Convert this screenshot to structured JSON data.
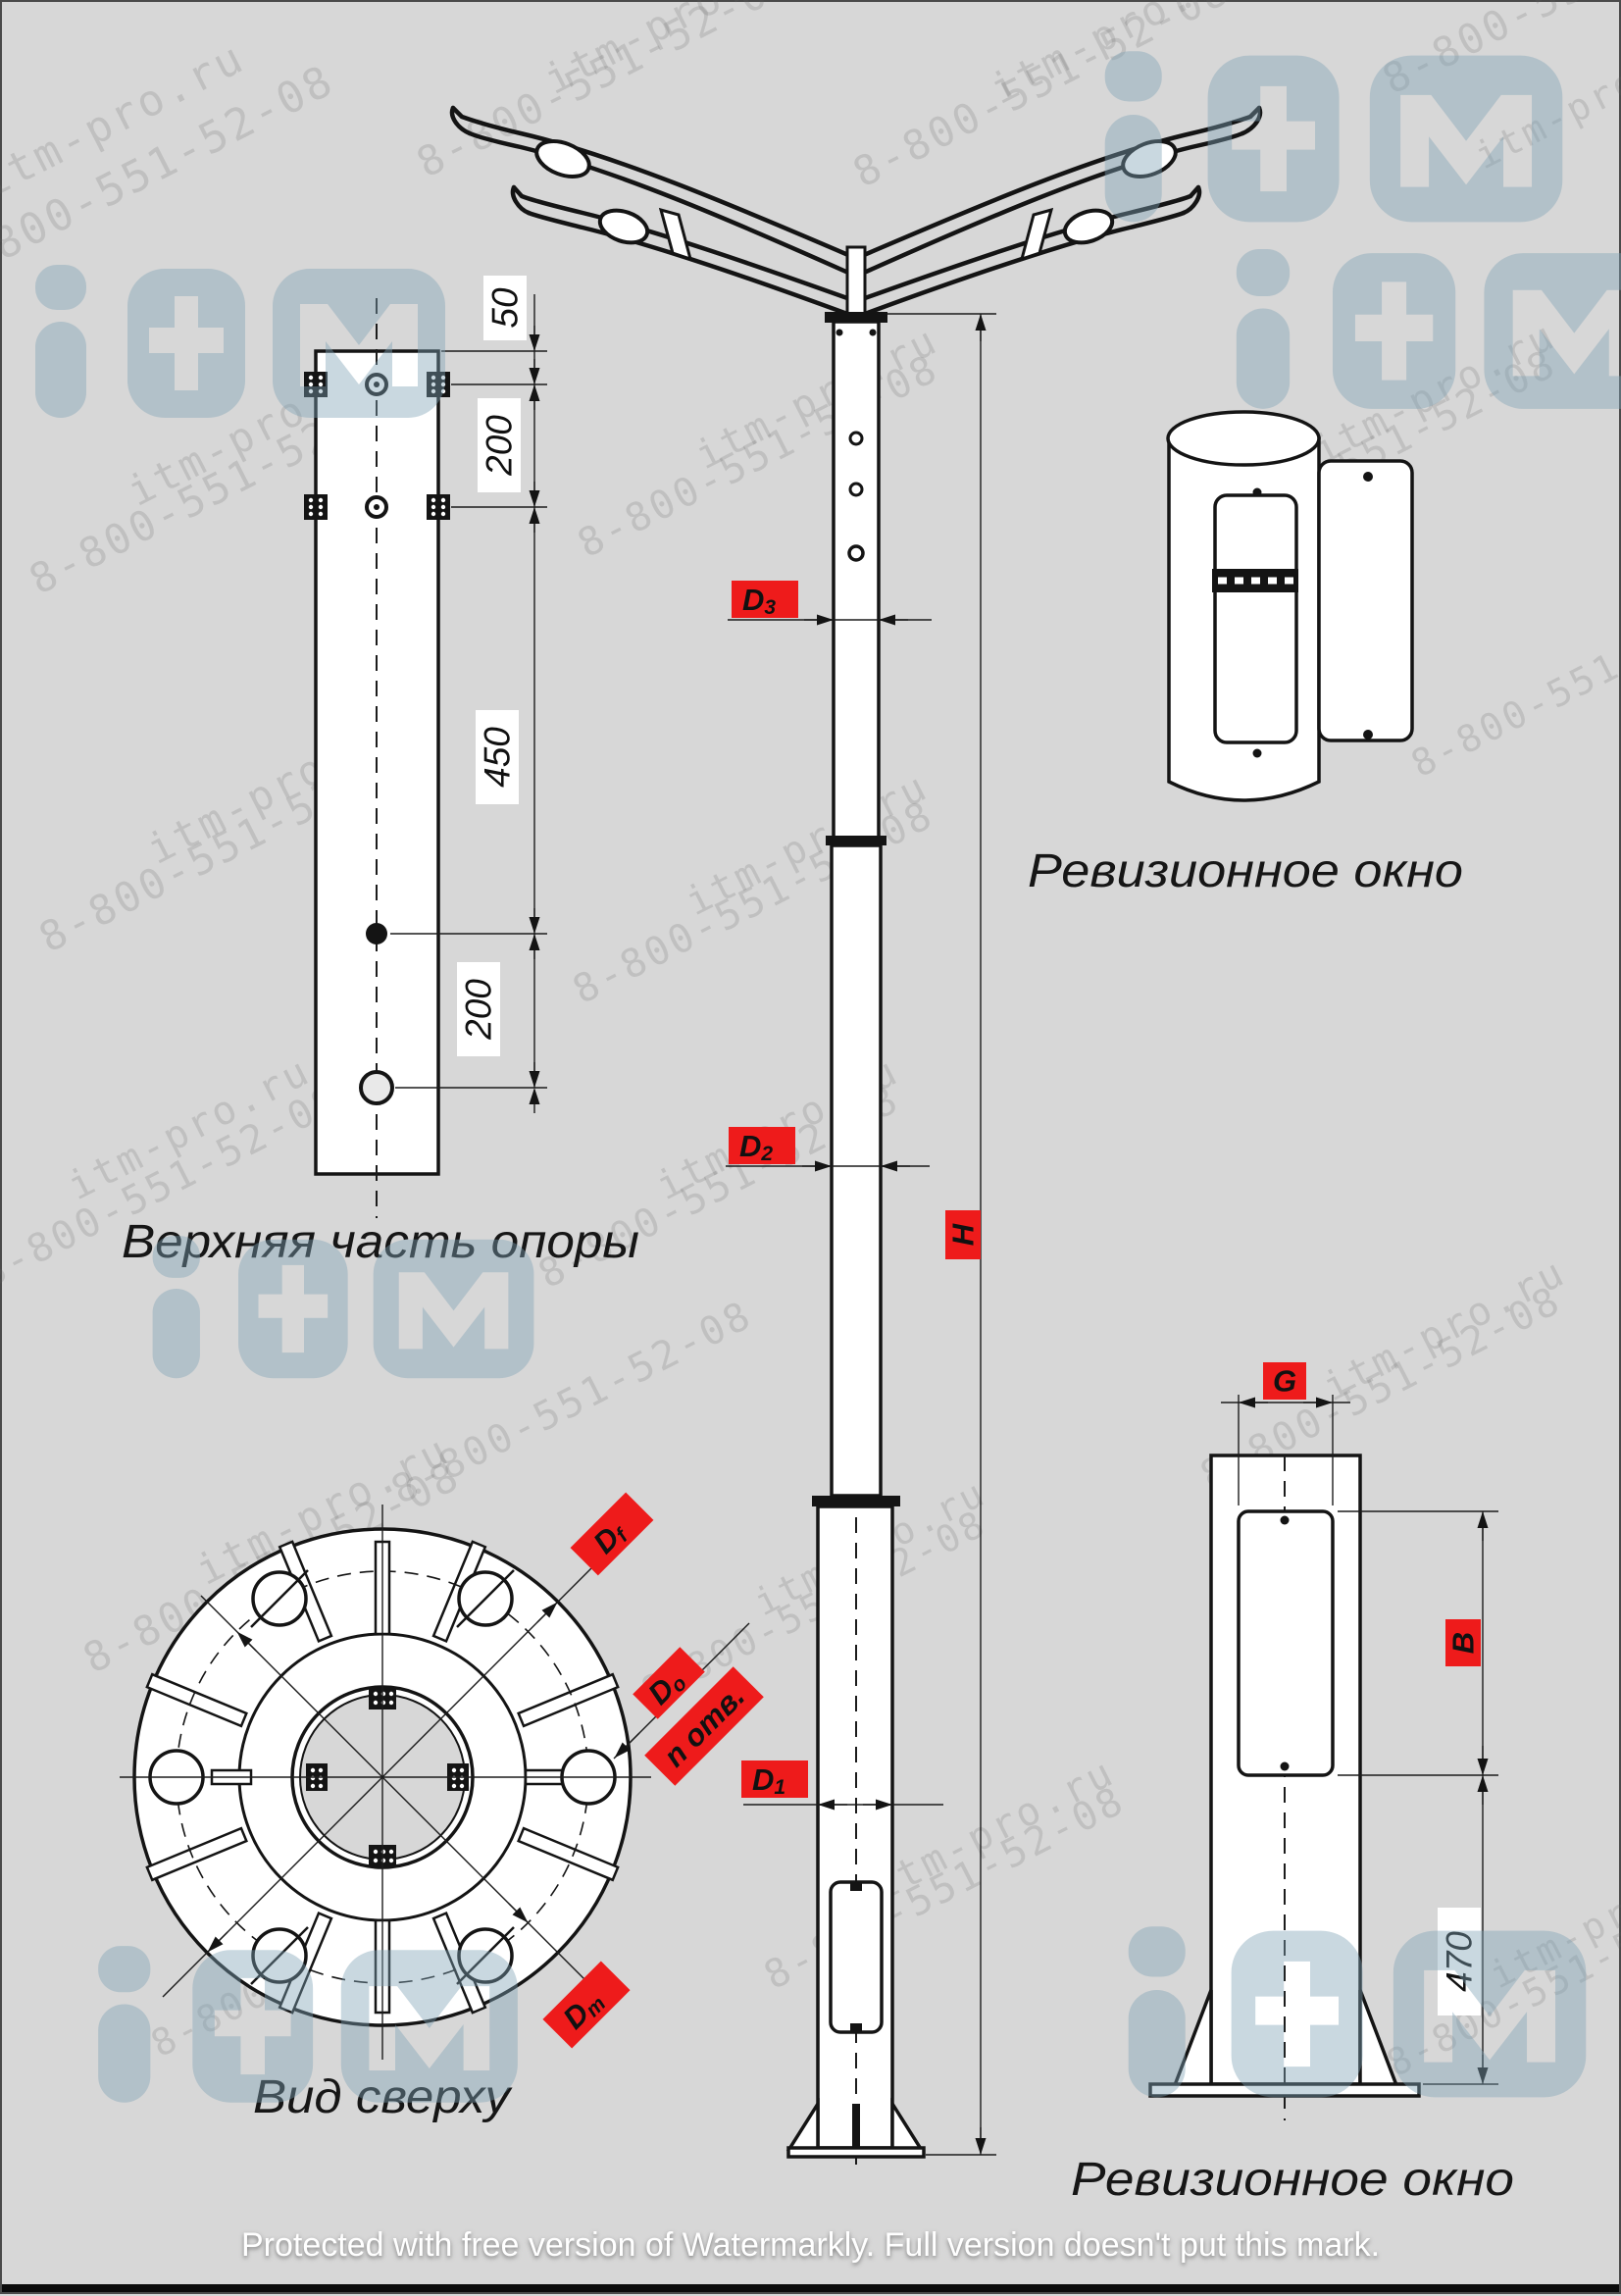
{
  "watermark": {
    "site": "itm-pro.ru",
    "phone": "8-800-551-52-08",
    "logo_m": "M",
    "protection": "Protected with free version of Watermarkly. Full version doesn't put this mark."
  },
  "captions": {
    "top_part": "Верхняя часть опоры",
    "top_view": "Вид сверху",
    "inspection_window": "Ревизионное окно"
  },
  "dims": {
    "d50": "50",
    "d200a": "200",
    "d450": "450",
    "d200b": "200",
    "d470": "470"
  },
  "labels": {
    "d3": {
      "m": "D",
      "s": "3"
    },
    "d2": {
      "m": "D",
      "s": "2"
    },
    "d1": {
      "m": "D",
      "s": "1"
    },
    "h": "H",
    "g": "G",
    "b": "B",
    "df": {
      "m": "D",
      "s": "f"
    },
    "dholes": {
      "m": "D",
      "s": "о"
    },
    "n_holes": "n отв.",
    "dm": {
      "m": "D",
      "s": "m"
    }
  },
  "colors": {
    "background": "#d7d7d7",
    "line": "#141414",
    "label_red": "#ee1b1b",
    "logo_blue": "#7fa3b5"
  }
}
